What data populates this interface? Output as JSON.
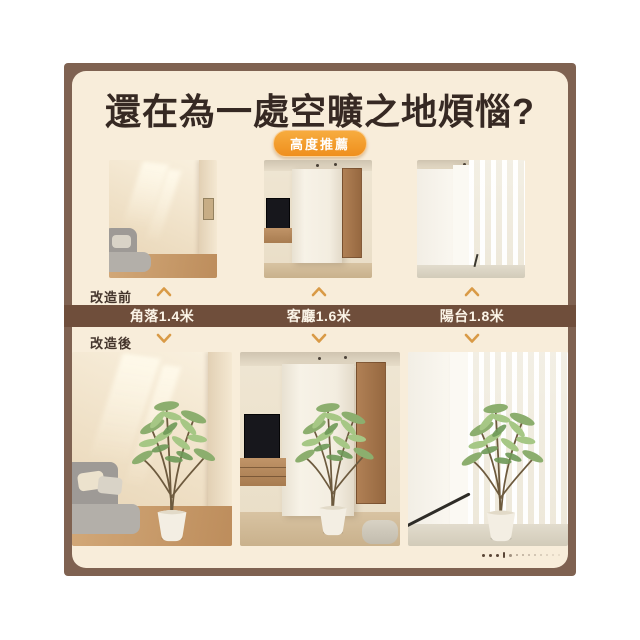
{
  "poster": {
    "title": "還在為一處空曠之地煩惱?",
    "badge": "高度推薦",
    "rows": {
      "before": "改造前",
      "after": "改造後"
    },
    "locations": [
      {
        "name": "corner",
        "label": "角落1.4米",
        "height_m": 1.4
      },
      {
        "name": "living-room",
        "label": "客廳1.6米",
        "height_m": 1.6
      },
      {
        "name": "balcony",
        "label": "陽台1.8米",
        "height_m": 1.8
      }
    ],
    "colors": {
      "frame_brown": "#7f6251",
      "card_cream": "#f8edda",
      "bar_brown": "#6f4e3b",
      "badge_orange": "#f19a2a",
      "arrow_gold": "#d99a46",
      "title_text": "#362923"
    }
  }
}
